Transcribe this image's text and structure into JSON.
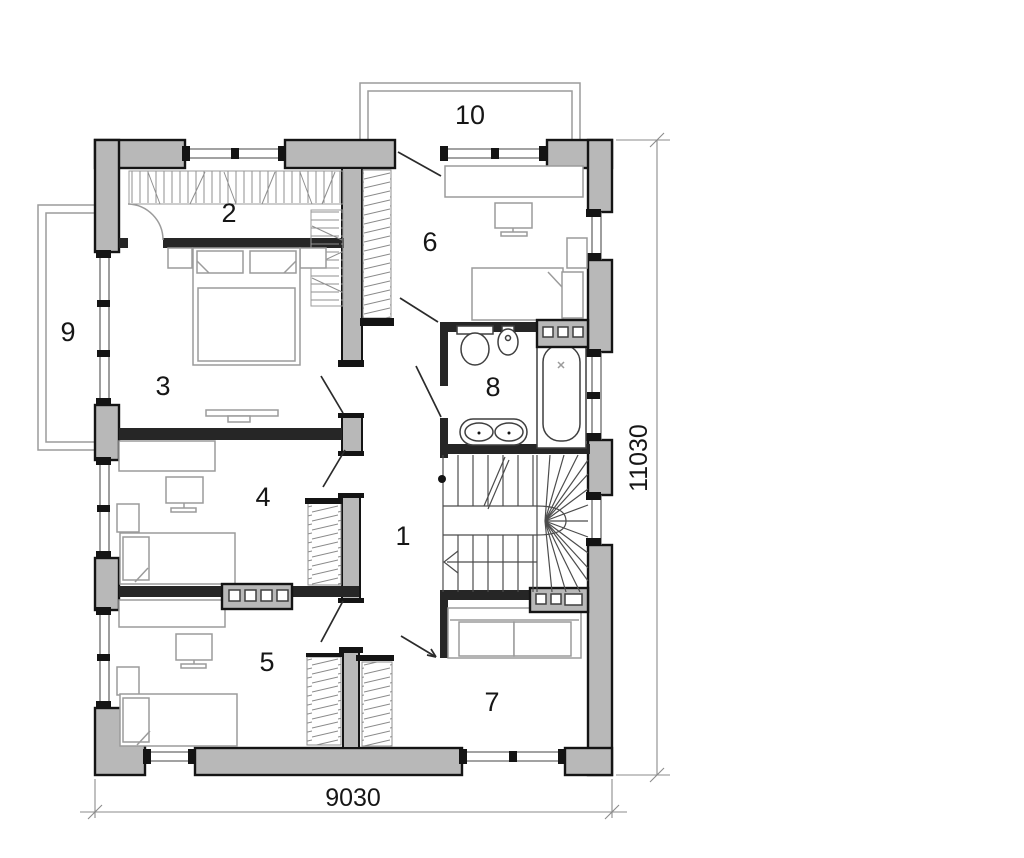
{
  "plan_type": "floor-plan",
  "rooms": [
    {
      "label": "1"
    },
    {
      "label": "2"
    },
    {
      "label": "3"
    },
    {
      "label": "4"
    },
    {
      "label": "5"
    },
    {
      "label": "6"
    },
    {
      "label": "7"
    },
    {
      "label": "8"
    },
    {
      "label": "9"
    },
    {
      "label": "10"
    }
  ],
  "dimensions": {
    "width_label": "9030",
    "height_label": "11030"
  },
  "colors": {
    "wall_fill": "#b8b8b8",
    "wall_outline": "#141414",
    "dark_wall": "#262626",
    "furniture_line": "#9b9b9b",
    "dimension_line": "#8b8b8b",
    "text_color": "#161616",
    "background": "#ffffff"
  }
}
